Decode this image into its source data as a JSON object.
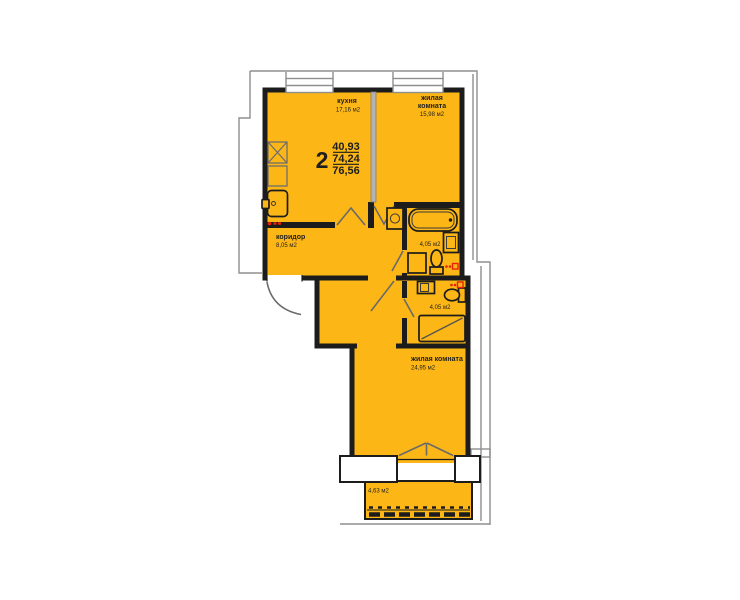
{
  "plan": {
    "info": {
      "rooms_count": "2",
      "living_area": "40,93",
      "apartment_area": "74,24",
      "total_area": "76,56"
    },
    "rooms": {
      "kitchen": {
        "name": "кухня",
        "area": "17,16 м2"
      },
      "living1": {
        "name_line1": "жилая",
        "name_line2": "комната",
        "area": "15,98 м2"
      },
      "corridor": {
        "name": "коридор",
        "area": "8,05 м2"
      },
      "bathroom1": {
        "area": "4,05 м2"
      },
      "bathroom2": {
        "area": "4,05 м2"
      },
      "living2": {
        "name": "жилая комната",
        "area": "24,95 м2"
      },
      "balcony": {
        "area": "4,63 м2"
      }
    },
    "colors": {
      "room_fill": "#FCB615",
      "wall": "#1C1C1C",
      "outline": "#8F8F8F",
      "marker": "#E8220A"
    }
  }
}
